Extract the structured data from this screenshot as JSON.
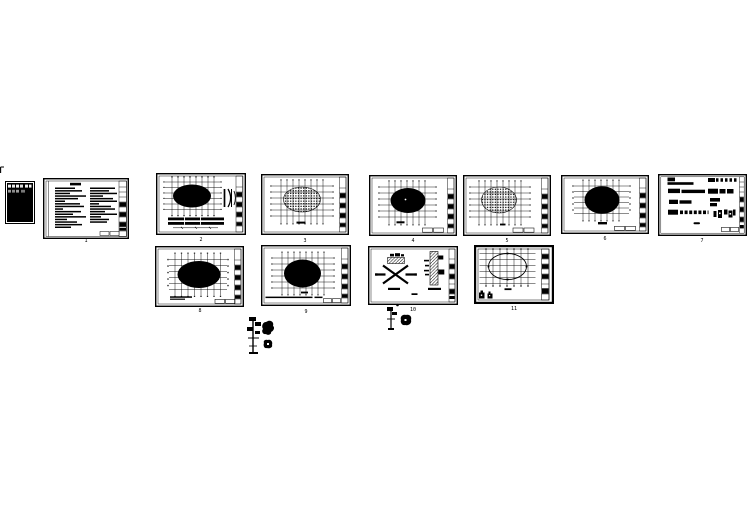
{
  "page": {
    "background": "#ffffff",
    "ink": "#000000"
  },
  "sheets": [
    {
      "id": "cover",
      "type": "dark-cover-sheet",
      "label": ""
    },
    {
      "id": "notes",
      "type": "design-notes-text-sheet",
      "label": "1"
    },
    {
      "id": "plan-a",
      "type": "floor-plan-solid-ellipse-with-tables",
      "label": "2"
    },
    {
      "id": "plan-b",
      "type": "floor-plan-dotted-ellipse",
      "label": "3"
    },
    {
      "id": "plan-c",
      "type": "floor-plan-solid-ellipse",
      "label": "4"
    },
    {
      "id": "plan-d",
      "type": "floor-plan-dotted-ellipse",
      "label": "5"
    },
    {
      "id": "plan-e",
      "type": "floor-plan-solid-ellipse",
      "label": "6"
    },
    {
      "id": "legend-f",
      "type": "schedule-legend-sheet",
      "label": "7"
    },
    {
      "id": "plan-g",
      "type": "floor-plan-solid-ellipse",
      "label": "8"
    },
    {
      "id": "plan-h",
      "type": "floor-plan-solid-ellipse-with-note",
      "label": "9"
    },
    {
      "id": "detail-i",
      "type": "bracing-and-section-detail-sheet",
      "label": "10"
    },
    {
      "id": "plan-j",
      "type": "roof-plan-outline-ellipse",
      "label": "11"
    }
  ],
  "stray_figures": [
    {
      "id": "tree-1",
      "type": "tree-elevation-detail"
    },
    {
      "id": "shrub-1",
      "type": "shrub-blob-detail"
    },
    {
      "id": "tree-2",
      "type": "tree-elevation-detail-small"
    },
    {
      "id": "shrub-2",
      "type": "shrub-blob-detail-small"
    },
    {
      "id": "tick",
      "type": "corner-tick-mark"
    }
  ]
}
